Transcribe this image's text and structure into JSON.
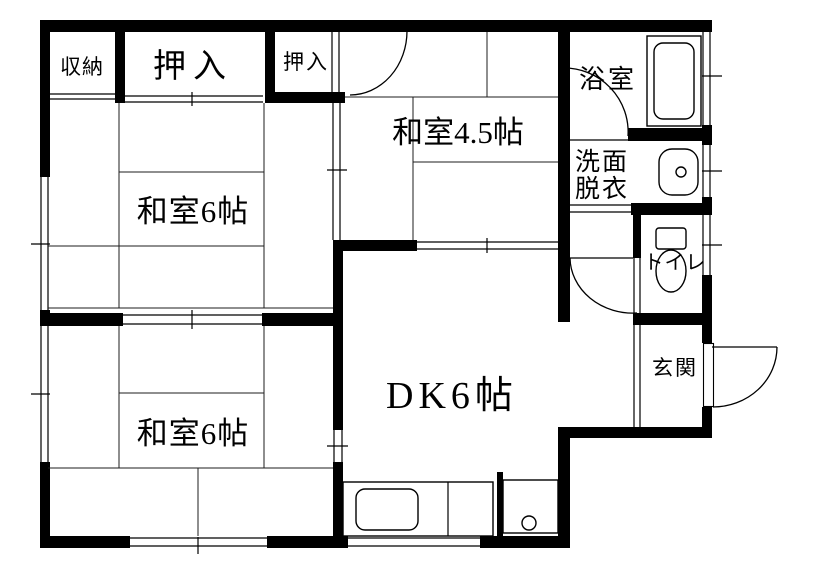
{
  "rooms": {
    "storage": {
      "label": "収納"
    },
    "closet_main": {
      "label": "押入"
    },
    "closet_small": {
      "label": "押入"
    },
    "japanese_room_upper": {
      "label": "和室6帖"
    },
    "japanese_room_45": {
      "label": "和室4.5帖"
    },
    "japanese_room_lower": {
      "label": "和室6帖"
    },
    "dining_kitchen": {
      "label": "DK6帖"
    },
    "bathroom": {
      "label": "浴室"
    },
    "washroom": {
      "label_line1": "洗面",
      "label_line2": "脱衣"
    },
    "toilet": {
      "label": "トイレ"
    },
    "entrance": {
      "label": "玄関"
    }
  },
  "fixtures": {
    "bathtub": "bathtub-icon",
    "wash_basin": "wash-basin-icon",
    "toilet_bowl": "toilet-icon",
    "kitchen_sink": "kitchen-sink-icon",
    "burner": "burner-icon"
  },
  "colors": {
    "wall": "#000000",
    "line": "#000000",
    "background": "#ffffff"
  }
}
